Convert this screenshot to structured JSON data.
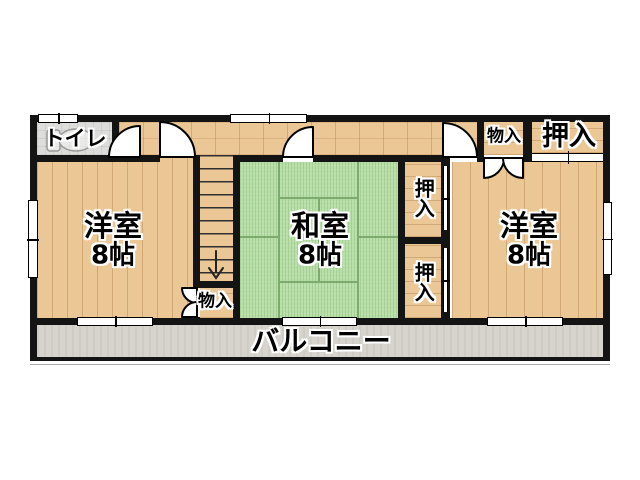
{
  "plan_type": "floor-plan",
  "rooms": {
    "toilet": {
      "label": "トイレ"
    },
    "western_left": {
      "label": "洋室",
      "size": "8帖"
    },
    "japanese": {
      "label": "和室",
      "size": "8帖"
    },
    "western_right": {
      "label": "洋室",
      "size": "8帖"
    },
    "closet_top_right": {
      "label": "押入"
    },
    "storage_top": {
      "label": "物入"
    },
    "closet_upper": {
      "label": "押入"
    },
    "closet_lower": {
      "label": "押入"
    },
    "storage_stairs": {
      "label": "物入"
    },
    "balcony": {
      "label": "バルコニー"
    }
  },
  "icons": {
    "stairs_down_arrow": "↓",
    "door_swing": "quarter-circle-arc",
    "toilet_fixture": "toilet-outline"
  },
  "colors": {
    "wall": "#141414",
    "wood": "#eac795",
    "tatami": "#b8dfa8",
    "tatami_line": "#7dab6d",
    "tile": "#dddddb",
    "balcony": "#d6d4cd",
    "window": "#ffffff"
  }
}
